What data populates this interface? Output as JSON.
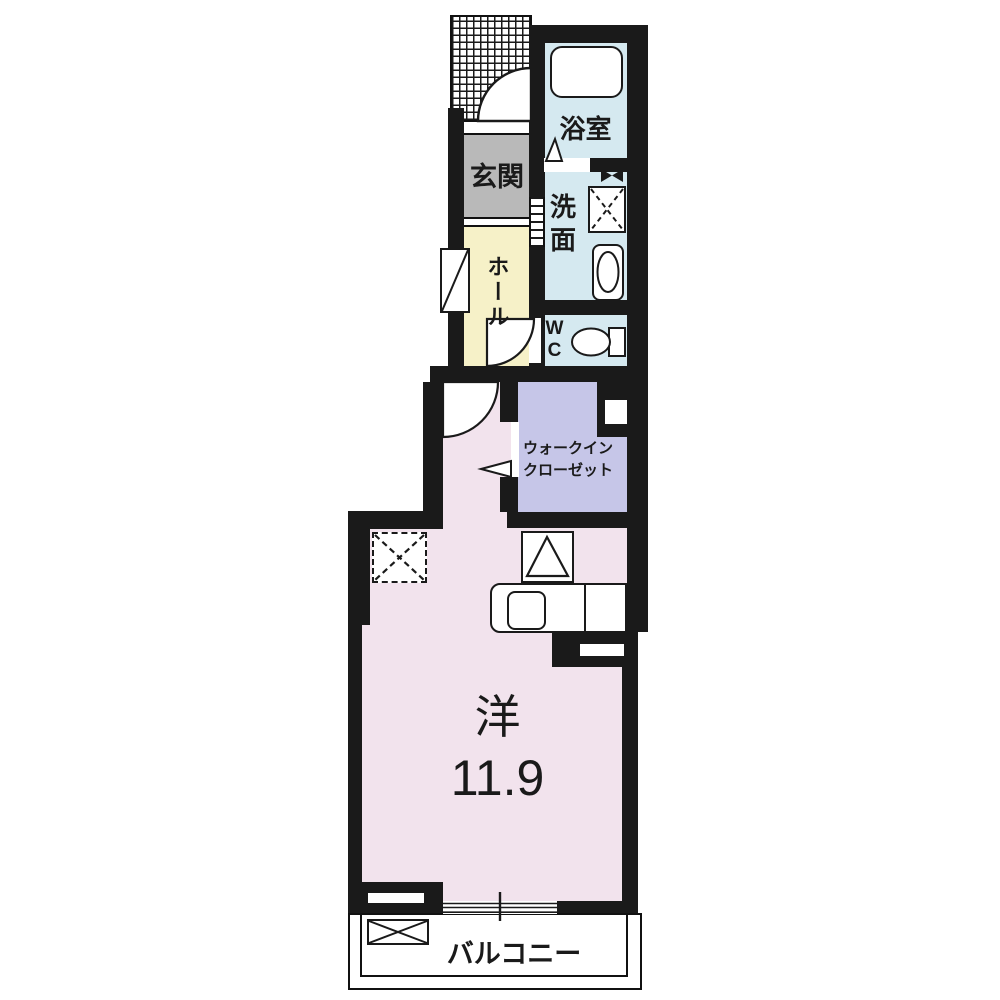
{
  "plan": {
    "rooms": {
      "genkan": {
        "name": "玄関"
      },
      "bath": {
        "name": "浴室"
      },
      "washroom": {
        "name": "洗面"
      },
      "hall": {
        "name": "ホール"
      },
      "wc": {
        "name": "WC"
      },
      "closet": {
        "name_line1": "ウォークイン",
        "name_line2": "クローゼット"
      },
      "main_room": {
        "type": "洋",
        "size": "11.9"
      },
      "balcony": {
        "name": "バルコニー"
      }
    },
    "colors": {
      "wall": "#1a1a1a",
      "genkan": "#b9b9b9",
      "bath": "#d5e9f0",
      "washroom": "#d5e9f0",
      "wc": "#d5e9f0",
      "hall": "#f6f1c8",
      "closet": "#c6c6e8",
      "main_room": "#f2e3ed",
      "balcony": "#ffffff"
    }
  }
}
